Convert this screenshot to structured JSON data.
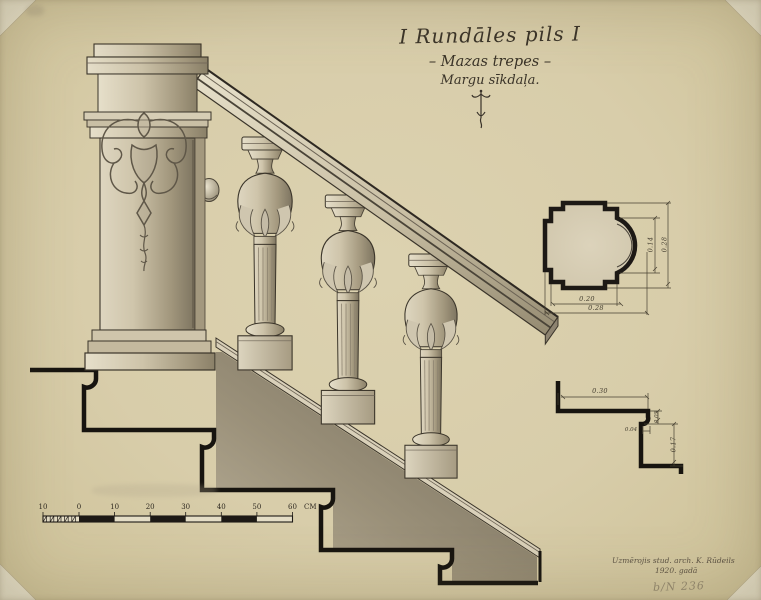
{
  "titles": {
    "main": "I Rundāles pils I",
    "subtitle": "– Mazas trepes –",
    "subtitle2": "Margu sīkdaļa."
  },
  "signature": {
    "line1": "Uzmērojis stud. arch. K. Rūdeils",
    "line2": "1920. gadā",
    "archive_number": "b/N 236"
  },
  "scale_bar": {
    "labels": [
      "10",
      "0",
      "10",
      "20",
      "30",
      "40",
      "50",
      "60"
    ],
    "unit": "CM"
  },
  "plan_detail": {
    "width_inner": "0.20",
    "width_outer": "0.28",
    "arc_depth": "0.14",
    "height": "0.28"
  },
  "step_profile": {
    "tread": "0.30",
    "nosing_height": "0.05",
    "nosing_depth": "0.04",
    "riser": "0.17"
  },
  "colors": {
    "paper": "#d8cdaa",
    "ink": "#201c16",
    "wash_dark": "#6e6659",
    "wash_light": "#c6bca6"
  }
}
